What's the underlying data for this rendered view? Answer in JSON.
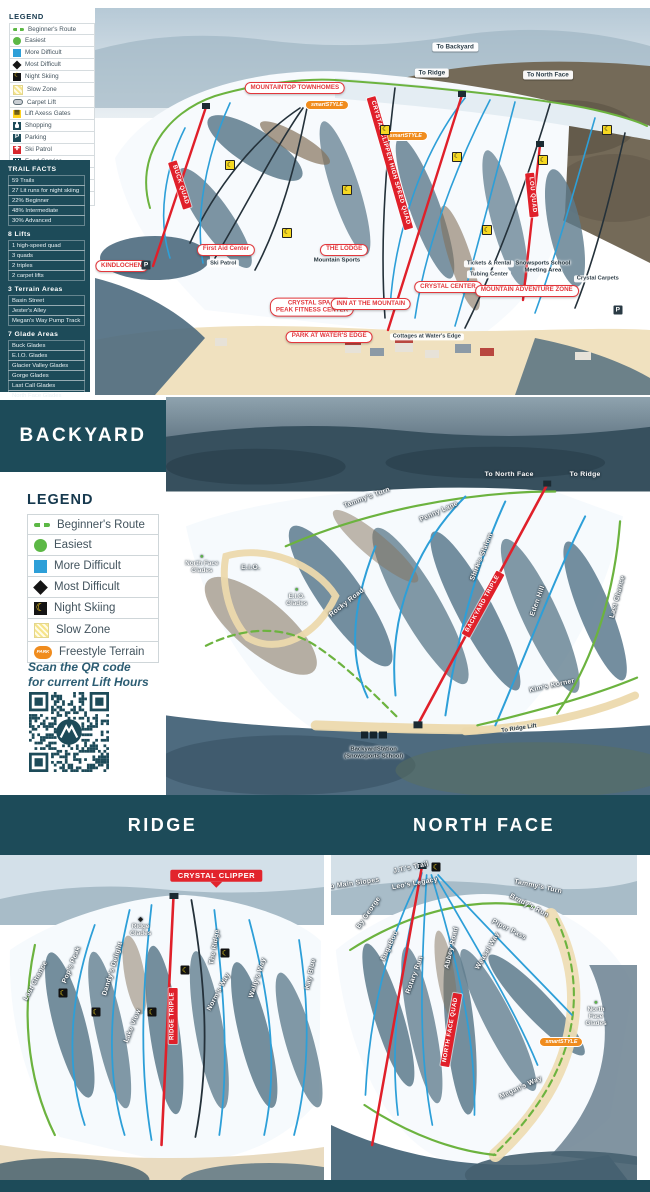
{
  "colors": {
    "teal_dark": "#1d4b59",
    "red": "#e0202a",
    "green": "#5cb845",
    "blue": "#2d9fd8",
    "yellow": "#ffd21e",
    "orange": "#f08c1e",
    "beige": "#f0e1bf"
  },
  "main_legend": {
    "title": "LEGEND",
    "items": [
      {
        "icon": "beginner-route-icon",
        "style": "beginner",
        "label": "Beginner's Route"
      },
      {
        "icon": "easiest-icon",
        "style": "easiest",
        "label": "Easiest"
      },
      {
        "icon": "more-difficult-icon",
        "style": "more",
        "label": "More Difficult"
      },
      {
        "icon": "most-difficult-icon",
        "style": "most",
        "label": "Most Difficult"
      },
      {
        "icon": "night-skiing-icon",
        "style": "night",
        "glyph": "☾",
        "label": "Night Skiing"
      },
      {
        "icon": "slow-zone-icon",
        "style": "slow",
        "label": "Slow Zone"
      },
      {
        "icon": "carpet-lift-icon",
        "style": "carpet",
        "label": "Carpet Lift"
      },
      {
        "icon": "lift-axess-gates-icon",
        "style": "axess",
        "glyph": "▦",
        "label": "Lift Axess Gates"
      },
      {
        "icon": "shopping-icon",
        "style": "shop",
        "label": "Shopping"
      },
      {
        "icon": "parking-icon",
        "style": "park",
        "glyph": "P",
        "label": "Parking"
      },
      {
        "icon": "ski-patrol-icon",
        "style": "patrol",
        "glyph": "✚",
        "label": "Ski Patrol"
      },
      {
        "icon": "food-service-icon",
        "style": "food",
        "label": "Food Service"
      },
      {
        "icon": "restrooms-icon",
        "style": "rest",
        "label": "Restrooms"
      },
      {
        "icon": "freestyle-terrain-icon",
        "style": "free",
        "glyph": "PARK",
        "label": "Freestyle Terrain"
      },
      {
        "icon": "ev-charging-icon",
        "style": "ev",
        "glyph": "⚡",
        "label": "EV Charging Station"
      }
    ]
  },
  "facts_panel": {
    "sections": [
      {
        "title": "TRAIL FACTS",
        "items": [
          "59 Trails",
          "27 Lit runs for night skiing",
          "22% Beginner",
          "48% Intermediate",
          "30% Advanced"
        ]
      },
      {
        "title": "8 Lifts",
        "items": [
          "1 high-speed quad",
          "3 quads",
          "2 triples",
          "2 carpet lifts"
        ]
      },
      {
        "title": "3 Terrain Areas",
        "items": [
          "Basin Street",
          "Jester's Alley",
          "Megan's Way Pump Track"
        ]
      },
      {
        "title": "7 Glade Areas",
        "items": [
          "Buck Glades",
          "E.I.O. Glades",
          "Glacier Valley Glades",
          "Gorge Glades",
          "Last Call Glades",
          "North Face Glades",
          "Ridge Glades"
        ]
      }
    ]
  },
  "backyard": {
    "title": "BACKYARD",
    "legend": {
      "title": "LEGEND",
      "items": [
        {
          "icon": "beginner-route-icon",
          "style": "beginner",
          "label": "Beginner's Route"
        },
        {
          "icon": "easiest-icon",
          "style": "easiest",
          "label": "Easiest"
        },
        {
          "icon": "more-difficult-icon",
          "style": "more",
          "label": "More Difficult"
        },
        {
          "icon": "most-difficult-icon",
          "style": "most",
          "label": "Most Difficult"
        },
        {
          "icon": "night-skiing-icon",
          "style": "night",
          "glyph": "☾",
          "label": "Night Skiing"
        },
        {
          "icon": "slow-zone-icon",
          "style": "slow",
          "label": "Slow Zone"
        },
        {
          "icon": "freestyle-terrain-icon",
          "style": "free",
          "glyph": "PARK",
          "label": "Freestyle Terrain"
        }
      ]
    },
    "qr_caption_line1": "Scan the QR code",
    "qr_caption_line2": "for current Lift Hours"
  },
  "sections": {
    "ridge_title": "RIDGE",
    "north_face_title": "NORTH FACE"
  },
  "maps": {
    "main": {
      "labels": [
        {
          "type": "pill-white",
          "x": 64.9,
          "y": 10.1,
          "text": "To Backyard"
        },
        {
          "type": "pill-white",
          "x": 60.7,
          "y": 16.8,
          "text": "To Ridge"
        },
        {
          "type": "pill-white",
          "x": 81.6,
          "y": 17.3,
          "text": "To North Face"
        },
        {
          "type": "badge-red",
          "x": 36,
          "y": 20.7,
          "text": "MOUNTAINTOP TOWNHOMES"
        },
        {
          "type": "badge-orange",
          "x": 41.8,
          "y": 25.1,
          "text": "smartSTYLE"
        },
        {
          "type": "badge-orange",
          "x": 56,
          "y": 33.1,
          "text": "smartSTYLE"
        },
        {
          "type": "lift",
          "x": 15.3,
          "y": 45.7,
          "rot": 72,
          "text": "BUCK QUAD"
        },
        {
          "type": "lift",
          "x": 53.2,
          "y": 40.1,
          "rot": 74,
          "text": "CRYSTAL CLIPPER HIGH SPEED QUAD"
        },
        {
          "type": "lift",
          "x": 78.7,
          "y": 48.3,
          "rot": 84,
          "text": "LOU QUAD"
        },
        {
          "type": "badge-red",
          "x": 23.6,
          "y": 62.5,
          "text": "First Aid Center"
        },
        {
          "type": "poi-white",
          "x": 23.1,
          "y": 66,
          "text": "Ski Patrol"
        },
        {
          "type": "badge-red",
          "x": 4.8,
          "y": 66.7,
          "text": "KINDLOCHEN"
        },
        {
          "type": "badge-red",
          "x": 44.9,
          "y": 62.5,
          "text": "THE LODGE"
        },
        {
          "type": "poi-dark-text",
          "x": 43.6,
          "y": 65.4,
          "text": "Mountain Sports"
        },
        {
          "type": "poi-white",
          "x": 71,
          "y": 66.1,
          "text": "Tickets & Rental"
        },
        {
          "type": "poi-white",
          "x": 71,
          "y": 68.8,
          "text": "Tubing Center"
        },
        {
          "type": "poi-dark-text",
          "x": 80.7,
          "y": 66.9,
          "text": "Snowsports School\nMeeting Area"
        },
        {
          "type": "poi-white",
          "x": 90.6,
          "y": 70,
          "text": "Crystal Carpets"
        },
        {
          "type": "badge-red",
          "x": 63.6,
          "y": 72.1,
          "text": "CRYSTAL CENTER"
        },
        {
          "type": "badge-red",
          "x": 77.8,
          "y": 73.1,
          "text": "MOUNTAIN ADVENTURE ZONE"
        },
        {
          "type": "badge-red",
          "x": 39.1,
          "y": 77.3,
          "text": "CRYSTAL SPA &\nPEAK FITNESS CENTER"
        },
        {
          "type": "badge-red",
          "x": 49.7,
          "y": 76.5,
          "text": "INN AT THE MOUNTAIN"
        },
        {
          "type": "badge-red",
          "x": 42.2,
          "y": 85,
          "text": "PARK AT WATER'S EDGE"
        },
        {
          "type": "poi-white",
          "x": 59.8,
          "y": 85,
          "text": "Cottages at Water's Edge"
        },
        {
          "type": "poi-dark",
          "x": 94.2,
          "y": 78,
          "text": "P"
        },
        {
          "type": "poi-dark",
          "x": 9.2,
          "y": 66.4,
          "text": "P"
        },
        {
          "type": "moon",
          "x": 24.3,
          "y": 40.6,
          "text": "☾"
        },
        {
          "type": "moon",
          "x": 34.6,
          "y": 58.1,
          "text": "☾"
        },
        {
          "type": "moon",
          "x": 45.4,
          "y": 47,
          "text": "☾"
        },
        {
          "type": "moon",
          "x": 52.3,
          "y": 31.5,
          "text": "☾"
        },
        {
          "type": "moon",
          "x": 65.2,
          "y": 38.5,
          "text": "☾"
        },
        {
          "type": "moon",
          "x": 70.6,
          "y": 57.4,
          "text": "☾"
        },
        {
          "type": "moon",
          "x": 80.7,
          "y": 39.3,
          "text": "☾"
        },
        {
          "type": "moon",
          "x": 92.3,
          "y": 31.5,
          "text": "☾"
        }
      ]
    },
    "backyard": {
      "labels": [
        {
          "type": "trail",
          "x": 70.9,
          "y": 19.5,
          "text": "To North Face"
        },
        {
          "type": "trail",
          "x": 86.6,
          "y": 19.5,
          "text": "To Ridge"
        },
        {
          "type": "trail",
          "x": 41.6,
          "y": 25.3,
          "rot": -20,
          "text": "Tammy's Turn"
        },
        {
          "type": "trail",
          "x": 56.5,
          "y": 29,
          "rot": -24,
          "text": "Penny Lane"
        },
        {
          "type": "trail",
          "x": 65.2,
          "y": 40.3,
          "rot": -68,
          "text": "Shirk's Slalom"
        },
        {
          "type": "lift",
          "x": 65.4,
          "y": 52,
          "rot": -61,
          "text": "BACKYARD TRIPLE"
        },
        {
          "type": "trail",
          "x": 76.9,
          "y": 51.2,
          "rot": -70,
          "text": "Eden Hill"
        },
        {
          "type": "trail",
          "x": 93.4,
          "y": 50.2,
          "rot": -75,
          "text": "Last Chance"
        },
        {
          "type": "trail",
          "x": 37.3,
          "y": 51.8,
          "rot": -38,
          "text": "Rocky Road"
        },
        {
          "type": "trail",
          "x": 17.5,
          "y": 43,
          "text": "E.I.O."
        },
        {
          "type": "glade",
          "x": 27,
          "y": 50.3,
          "sym": "●",
          "symColor": "#5cb845",
          "text": "E.I.O.\nGlades"
        },
        {
          "type": "glade",
          "x": 7.4,
          "y": 42,
          "sym": "●",
          "symColor": "#5cb845",
          "text": "North Face\nGlades"
        },
        {
          "type": "trail",
          "x": 79.8,
          "y": 72.5,
          "rot": -12,
          "text": "Kim's Korner"
        },
        {
          "type": "poi-dark-text",
          "x": 73,
          "y": 83.3,
          "rot": -8,
          "text": "To Ridge Lift"
        },
        {
          "type": "train",
          "x": 42.9,
          "y": 85,
          "text": ""
        },
        {
          "type": "poi-dark-text",
          "x": 42.9,
          "y": 89.5,
          "text": "BackyardStation\n(Snowsports School)"
        }
      ]
    },
    "ridge": {
      "labels": [
        {
          "type": "red-solid",
          "x": 66.8,
          "y": 6.2,
          "arrow": true,
          "text": "CRYSTAL CLIPPER"
        },
        {
          "type": "glade",
          "x": 43.4,
          "y": 21.4,
          "sym": "◆",
          "symColor": "#1a1a1a",
          "text": "Ridge\nGlades"
        },
        {
          "type": "lift",
          "x": 53.5,
          "y": 47.8,
          "rot": -90,
          "text": "RIDGE TRIPLE"
        },
        {
          "type": "trail",
          "x": 66.5,
          "y": 27.3,
          "rot": -80,
          "text": "The Ridge"
        },
        {
          "type": "trail",
          "x": 67.7,
          "y": 40.7,
          "rot": -62,
          "text": "Norm's Way"
        },
        {
          "type": "trail",
          "x": 79.7,
          "y": 36.5,
          "rot": -72,
          "text": "Wally's Way"
        },
        {
          "type": "trail",
          "x": 96,
          "y": 35.3,
          "rot": -78,
          "text": "Kay Blue"
        },
        {
          "type": "trail",
          "x": 11.1,
          "y": 37.4,
          "rot": -62,
          "text": "Last Chance"
        },
        {
          "type": "trail",
          "x": 22.2,
          "y": 32.6,
          "rot": -68,
          "text": "Pop's Peak"
        },
        {
          "type": "trail",
          "x": 34.8,
          "y": 33.8,
          "rot": -73,
          "text": "Dandy's Delight"
        },
        {
          "type": "trail",
          "x": 41.2,
          "y": 50.7,
          "rot": -68,
          "text": "Lake View"
        },
        {
          "type": "moon-dark",
          "x": 19.4,
          "y": 40.9,
          "text": "☾"
        },
        {
          "type": "moon-dark",
          "x": 29.5,
          "y": 46.6,
          "text": "☾"
        },
        {
          "type": "moon-dark",
          "x": 46.8,
          "y": 46.6,
          "text": "☾"
        },
        {
          "type": "moon-dark",
          "x": 57.2,
          "y": 34.1,
          "text": "☾"
        },
        {
          "type": "moon-dark",
          "x": 69.5,
          "y": 29.1,
          "text": "☾"
        }
      ]
    },
    "north_face": {
      "labels": [
        {
          "type": "trail",
          "x": 26.3,
          "y": 3.9,
          "rot": -12,
          "text": "J.T.'s Trail"
        },
        {
          "type": "moon-dark",
          "x": 34.4,
          "y": 3.6,
          "text": "☾"
        },
        {
          "type": "trail",
          "x": 7.2,
          "y": 8.6,
          "rot": -8,
          "text": "To Main Slopes"
        },
        {
          "type": "trail",
          "x": 27.5,
          "y": 8.6,
          "rot": -10,
          "text": "Leo's Legacy"
        },
        {
          "type": "trail",
          "x": 67.8,
          "y": 9.5,
          "rot": 12,
          "text": "Tammy's Turn"
        },
        {
          "type": "trail",
          "x": 64.7,
          "y": 15.1,
          "rot": 28,
          "text": "Brady's Run"
        },
        {
          "type": "trail",
          "x": 58.1,
          "y": 22.3,
          "rot": 27,
          "text": "Piper Pass"
        },
        {
          "type": "trail",
          "x": 12.5,
          "y": 17.2,
          "rot": -55,
          "text": "By George"
        },
        {
          "type": "trail",
          "x": 19.4,
          "y": 27,
          "rot": -65,
          "text": "BugaBoo"
        },
        {
          "type": "trail",
          "x": 27.5,
          "y": 35.6,
          "rot": -70,
          "text": "Rotary Run"
        },
        {
          "type": "trail",
          "x": 39.4,
          "y": 27.6,
          "rot": -77,
          "text": "Abbey Road"
        },
        {
          "type": "trail",
          "x": 51.2,
          "y": 28.5,
          "rot": -60,
          "text": "Weasel Way"
        },
        {
          "type": "lift",
          "x": 39.1,
          "y": 51.9,
          "rot": -80,
          "text": "NORTH FACE QUAD"
        },
        {
          "type": "trail",
          "x": 62.2,
          "y": 69.1,
          "rot": -25,
          "text": "Megan's Way"
        },
        {
          "type": "glade",
          "x": 86.6,
          "y": 47.2,
          "sym": "●",
          "symColor": "#5cb845",
          "text": "North\nFace\nGlades"
        },
        {
          "type": "badge-orange",
          "x": 75.3,
          "y": 55.5,
          "text": "smartSTYLE"
        }
      ]
    }
  }
}
